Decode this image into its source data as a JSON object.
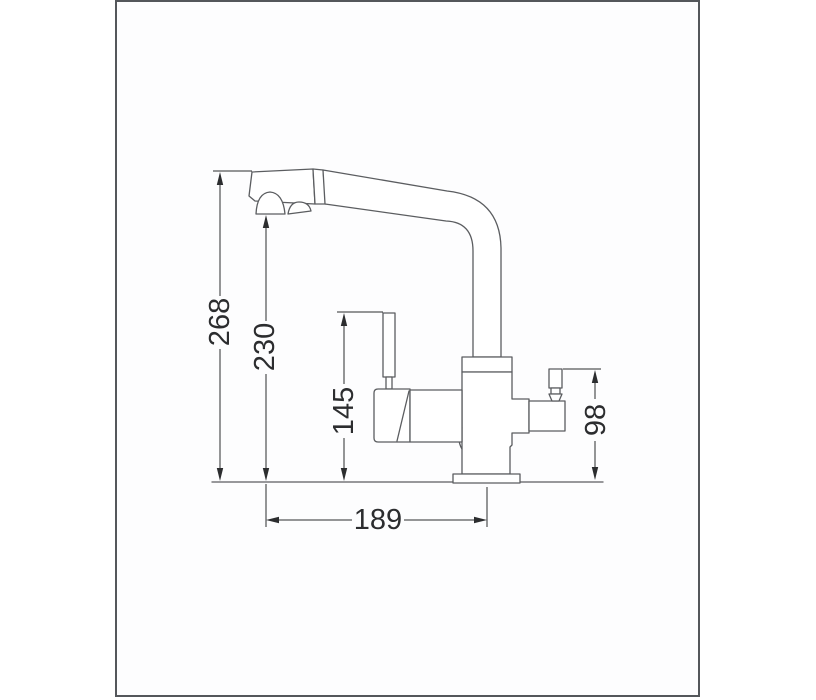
{
  "page": {
    "background": "#ffffff"
  },
  "frame": {
    "border_color": "#54575b",
    "fill": "#fdfdfe"
  },
  "drawing": {
    "kind": "faucet side-view technical line drawing",
    "line_color": "#5b5d60",
    "dimension_color": "#2c2d2f",
    "dimensions": {
      "overall_height": "268",
      "spout_outlet_height": "230",
      "lever_top_height": "145",
      "side_handle_height": "98",
      "spout_reach": "189"
    }
  }
}
